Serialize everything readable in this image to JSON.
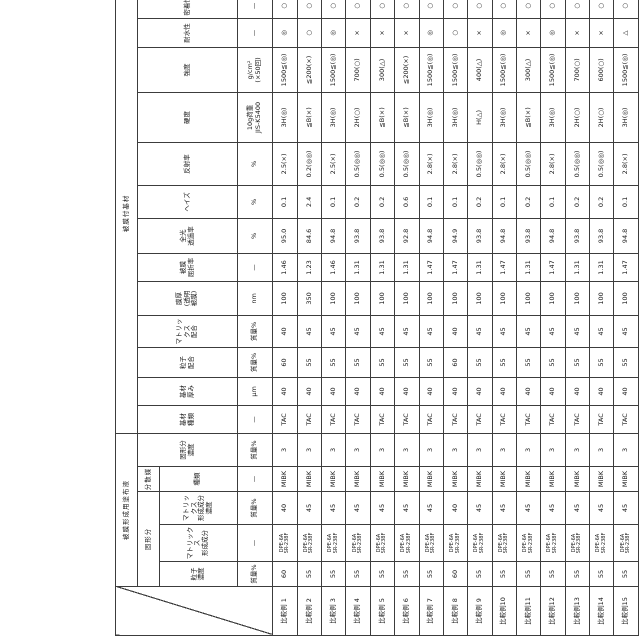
{
  "page": {
    "background": "#ffffff",
    "line_color": "#3c3c3c"
  },
  "table": {
    "groups": {
      "coating_liquid": "被膜形成用塗布液",
      "coated_substrate": "被膜付基材"
    },
    "subgroups": {
      "solid_content": "固形分",
      "dispersion_medium": "分散媒"
    },
    "columns": [
      {
        "key": "particle_conc",
        "name": "粒子\n濃度",
        "unit": "質量%",
        "group": "coating_liquid",
        "subgroup": "solid_content",
        "width": 25
      },
      {
        "key": "matrix_component",
        "name": "マトリックス\n形成成分",
        "unit": "—",
        "group": "coating_liquid",
        "subgroup": "solid_content",
        "width": 37
      },
      {
        "key": "matrix_conc",
        "name": "マトリックス\n形成成分\n濃度",
        "unit": "質量%",
        "group": "coating_liquid",
        "subgroup": "solid_content",
        "width": 33
      },
      {
        "key": "medium_type",
        "name": "種類",
        "unit": "—",
        "group": "coating_liquid",
        "subgroup": "dispersion_medium",
        "width": 25
      },
      {
        "key": "solid_conc",
        "name": "固形分\n濃度",
        "unit": "質量%",
        "group": "coating_liquid",
        "subgroup": null,
        "width": 33
      },
      {
        "key": "substrate_type",
        "name": "基材\n種類",
        "unit": "—",
        "group": "coated_substrate",
        "subgroup": null,
        "width": 28
      },
      {
        "key": "substrate_thickness",
        "name": "基材\n厚み",
        "unit": "μm",
        "group": "coated_substrate",
        "subgroup": null,
        "width": 28
      },
      {
        "key": "particle_blend",
        "name": "粒子\n配合",
        "unit": "質量%",
        "group": "coated_substrate",
        "subgroup": null,
        "width": 30
      },
      {
        "key": "matrix_blend",
        "name": "マトリックス\n配合",
        "unit": "質量%",
        "group": "coated_substrate",
        "subgroup": null,
        "width": 32
      },
      {
        "key": "film_thickness",
        "name": "膜厚\n(透明\n被膜)",
        "unit": "nm",
        "group": "coated_substrate",
        "subgroup": null,
        "width": 34
      },
      {
        "key": "refractive_index",
        "name": "被膜\n屈折率",
        "unit": "—",
        "group": "coated_substrate",
        "subgroup": null,
        "width": 28
      },
      {
        "key": "transmittance",
        "name": "全光\n透過率",
        "unit": "%",
        "group": "coated_substrate",
        "subgroup": null,
        "width": 35
      },
      {
        "key": "haze",
        "name": "ヘイズ",
        "unit": "%",
        "group": "coated_substrate",
        "subgroup": null,
        "width": 33
      },
      {
        "key": "reflectance",
        "name": "反射率",
        "unit": "%",
        "group": "coated_substrate",
        "subgroup": null,
        "width": 43
      },
      {
        "key": "hardness",
        "name": "硬度",
        "unit": "10g荷重\nJIS-K5400",
        "group": "coated_substrate",
        "subgroup": null,
        "width": 50
      },
      {
        "key": "strength",
        "name": "強度",
        "unit": "g/cm²\n(×50回)",
        "group": "coated_substrate",
        "subgroup": null,
        "width": 45
      },
      {
        "key": "water_resistance",
        "name": "耐水性",
        "unit": "—",
        "group": "coated_substrate",
        "subgroup": null,
        "width": 29
      },
      {
        "key": "adhesion",
        "name": "密着性",
        "unit": "—",
        "group": "coated_substrate",
        "subgroup": null,
        "width": 25
      }
    ],
    "label_col_width": 49,
    "matrix_component_value": "DPE-6A\nSR-238F",
    "rows": [
      {
        "label": "比較例 1",
        "values": [
          "60",
          "DPE-6A\nSR-238F",
          "40",
          "MIBK",
          "3",
          "TAC",
          "40",
          "60",
          "40",
          "100",
          "1.46",
          "95.0",
          "0.1",
          "2.5(×)",
          "3H(◎)",
          "1500≦(◎)",
          "◎",
          "○"
        ]
      },
      {
        "label": "比較例 2",
        "values": [
          "55",
          "DPE-6A\nSR-238F",
          "45",
          "MIBK",
          "3",
          "TAC",
          "40",
          "55",
          "45",
          "350",
          "1.23",
          "84.6",
          "2.4",
          "0.2(◎◎)",
          "≦B(×)",
          "≦200(×)",
          "○",
          "○"
        ]
      },
      {
        "label": "比較例 3",
        "values": [
          "55",
          "DPE-6A\nSR-238F",
          "45",
          "MIBK",
          "3",
          "TAC",
          "40",
          "55",
          "45",
          "100",
          "1.46",
          "94.8",
          "0.1",
          "2.5(×)",
          "3H(◎)",
          "1500≦(◎)",
          "◎",
          "○"
        ]
      },
      {
        "label": "比較例 4",
        "values": [
          "55",
          "DPE-6A\nSR-238F",
          "45",
          "MIBK",
          "3",
          "TAC",
          "40",
          "55",
          "45",
          "100",
          "1.31",
          "93.8",
          "0.2",
          "0.5(◎◎)",
          "2H(○)",
          "700(○)",
          "×",
          "○"
        ]
      },
      {
        "label": "比較例 5",
        "values": [
          "55",
          "DPE-6A\nSR-238F",
          "45",
          "MIBK",
          "3",
          "TAC",
          "40",
          "55",
          "45",
          "100",
          "1.31",
          "93.8",
          "0.2",
          "0.5(◎◎)",
          "≦B(×)",
          "300(△)",
          "×",
          "○"
        ]
      },
      {
        "label": "比較例 6",
        "values": [
          "55",
          "DPE-6A\nSR-238F",
          "45",
          "MIBK",
          "3",
          "TAC",
          "40",
          "55",
          "45",
          "100",
          "1.31",
          "92.8",
          "0.6",
          "0.5(◎◎)",
          "≦B(×)",
          "≦200(×)",
          "×",
          "○"
        ]
      },
      {
        "label": "比較例 7",
        "values": [
          "55",
          "DPE-6A\nSR-238F",
          "45",
          "MIBK",
          "3",
          "TAC",
          "40",
          "55",
          "45",
          "100",
          "1.47",
          "94.8",
          "0.1",
          "2.8(×)",
          "3H(◎)",
          "1500≦(◎)",
          "◎",
          "○"
        ]
      },
      {
        "label": "比較例 8",
        "values": [
          "60",
          "DPE-6A\nSR-238F",
          "40",
          "MIBK",
          "3",
          "TAC",
          "40",
          "60",
          "40",
          "100",
          "1.47",
          "94.9",
          "0.1",
          "2.8(×)",
          "3H(◎)",
          "1500≦(◎)",
          "○",
          "○"
        ]
      },
      {
        "label": "比較例 9",
        "values": [
          "55",
          "DPE-6A\nSR-238F",
          "45",
          "MIBK",
          "3",
          "TAC",
          "40",
          "55",
          "45",
          "100",
          "1.31",
          "93.8",
          "0.2",
          "0.5(◎◎)",
          "H(△)",
          "400(△)",
          "×",
          "○"
        ]
      },
      {
        "label": "比較例10",
        "values": [
          "55",
          "DPE-6A\nSR-238F",
          "45",
          "MIBK",
          "3",
          "TAC",
          "40",
          "55",
          "45",
          "100",
          "1.47",
          "94.8",
          "0.1",
          "2.8(×)",
          "3H(◎)",
          "1500≦(◎)",
          "◎",
          "○"
        ]
      },
      {
        "label": "比較例11",
        "values": [
          "55",
          "DPE-6A\nSR-238F",
          "45",
          "MIBK",
          "3",
          "TAC",
          "40",
          "55",
          "45",
          "100",
          "1.31",
          "93.8",
          "0.2",
          "0.5(◎◎)",
          "≦B(×)",
          "300(△)",
          "×",
          "○"
        ]
      },
      {
        "label": "比較例12",
        "values": [
          "55",
          "DPE-6A\nSR-238F",
          "45",
          "MIBK",
          "3",
          "TAC",
          "40",
          "55",
          "45",
          "100",
          "1.47",
          "94.8",
          "0.1",
          "2.8(×)",
          "3H(◎)",
          "1500≦(◎)",
          "◎",
          "○"
        ]
      },
      {
        "label": "比較例13",
        "values": [
          "55",
          "DPE-6A\nSR-238F",
          "45",
          "MIBK",
          "3",
          "TAC",
          "40",
          "55",
          "45",
          "100",
          "1.31",
          "93.8",
          "0.2",
          "0.5(◎◎)",
          "2H(○)",
          "700(○)",
          "×",
          "○"
        ]
      },
      {
        "label": "比較例14",
        "values": [
          "55",
          "DPE-6A\nSR-238F",
          "45",
          "MIBK",
          "3",
          "TAC",
          "40",
          "55",
          "45",
          "100",
          "1.31",
          "93.8",
          "0.2",
          "0.5(◎◎)",
          "2H(○)",
          "600(○)",
          "×",
          "○"
        ]
      },
      {
        "label": "比較例15",
        "values": [
          "55",
          "DPE-6A\nSR-238F",
          "45",
          "MIBK",
          "3",
          "TAC",
          "40",
          "55",
          "45",
          "100",
          "1.47",
          "94.8",
          "0.1",
          "2.8(×)",
          "3H(◎)",
          "1500≦(◎)",
          "△",
          "○"
        ]
      }
    ],
    "row_heights": {
      "group": 22,
      "subgroup": 21,
      "name": 77,
      "unit": 35
    }
  }
}
